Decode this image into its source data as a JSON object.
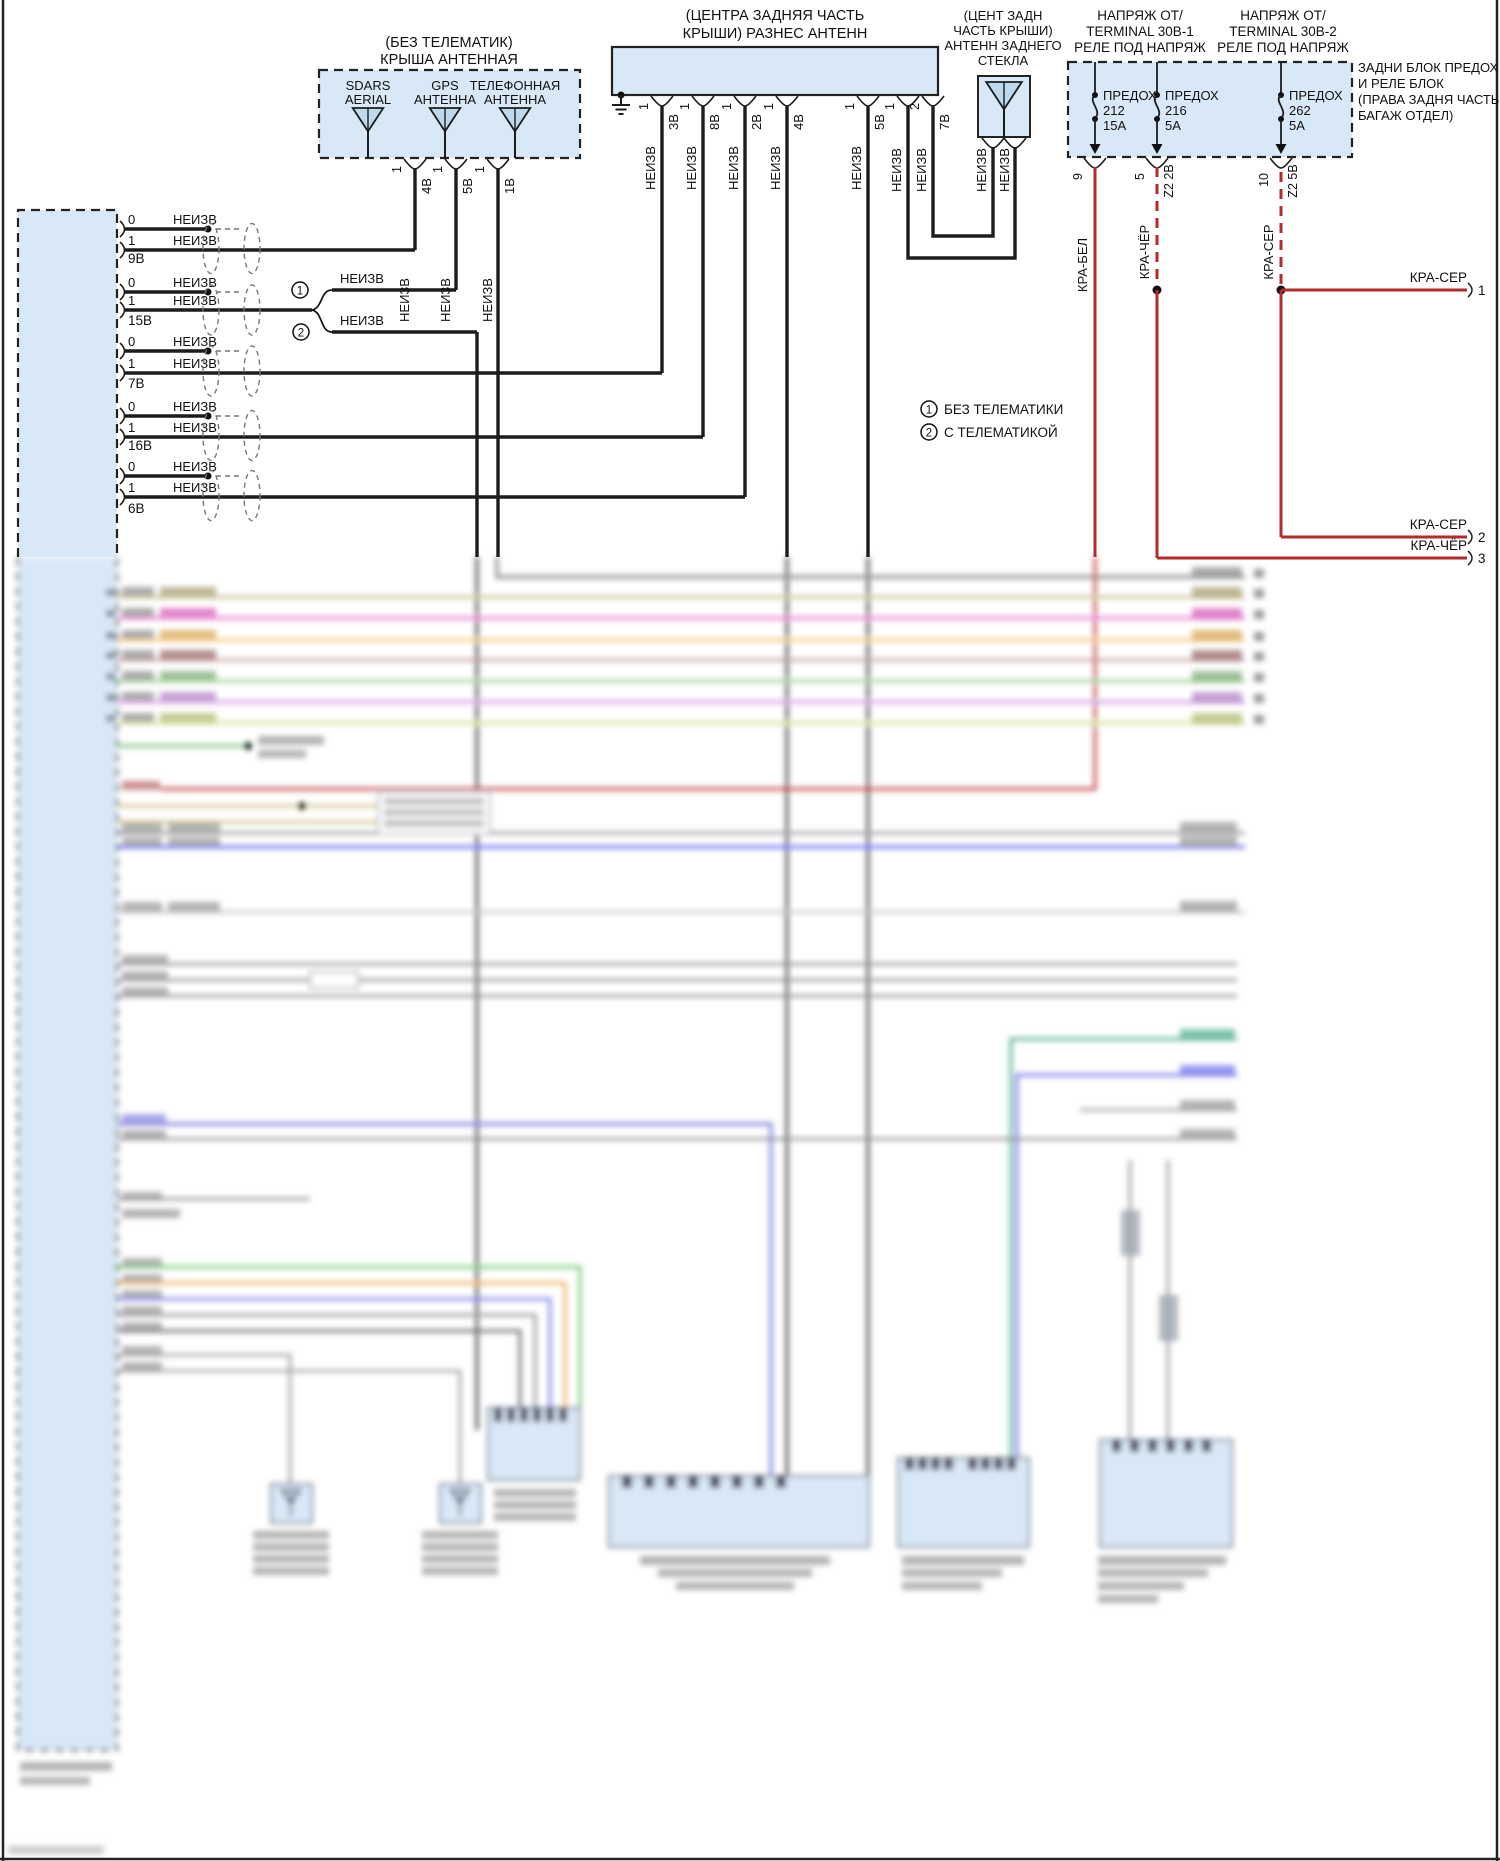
{
  "colors": {
    "box_fill": "#d9e8f7",
    "antenna_fill": "#bed8ee",
    "wire": "#1c1c1c",
    "red_wire": "#b32b2b",
    "border": "#222222"
  },
  "roof_antenna_module": {
    "title_line1": "(БЕЗ ТЕЛЕМАТИК)",
    "title_line2": "КРЫША АНТЕННАЯ",
    "antennas": [
      {
        "line1": "SDARS",
        "line2": "AERIAL"
      },
      {
        "line1": "GPS",
        "line2": "АНТЕННА"
      },
      {
        "line1": "ТЕЛЕФОННАЯ",
        "line2": "АНТЕННА"
      }
    ],
    "pins": [
      {
        "num": "1",
        "wire": "4В"
      },
      {
        "num": "1",
        "wire": "5В"
      },
      {
        "num": "1",
        "wire": "1В"
      }
    ]
  },
  "center_antenna_module": {
    "title_line1": "(ЦЕНТРА ЗАДНЯЯ ЧАСТЬ",
    "title_line2": "КРЫШИ) РАЗНЕС АНТЕНН",
    "pins": [
      {
        "num": "1",
        "wire": "3В"
      },
      {
        "num": "1",
        "wire": "8В"
      },
      {
        "num": "1",
        "wire": "2В"
      },
      {
        "num": "1",
        "wire": "4В"
      },
      {
        "num": "1",
        "wire": "5В"
      },
      {
        "num": "1",
        "wire": ""
      },
      {
        "num": "2",
        "wire": "7В"
      }
    ]
  },
  "rear_glass_antenna_module": {
    "title_lines": [
      "(ЦЕНТ ЗАДН",
      "ЧАСТЬ КРЫШИ)",
      "АНТЕНН ЗАДНЕГО",
      "СТЕКЛА"
    ]
  },
  "fuse_panel": {
    "source_left_lines": [
      "НАПРЯЖ ОТ/",
      "TERMINAL 30В-1",
      "РЕЛЕ ПОД НАПРЯЖ"
    ],
    "source_right_lines": [
      "НАПРЯЖ ОТ/",
      "TERMINAL 30В-2",
      "РЕЛЕ ПОД НАПРЯЖ"
    ],
    "location_note_lines": [
      "ЗАДНИ БЛОК ПРЕДОХ",
      "И РЕЛЕ БЛОК",
      "(ПРАВА ЗАДНЯ ЧАСТЬ",
      "БАГАЖ ОТДЕЛ)"
    ],
    "fuses": [
      {
        "label": "ПРЕДОХ",
        "number": "212",
        "rating": "15А"
      },
      {
        "label": "ПРЕДОХ",
        "number": "216",
        "rating": "5А"
      },
      {
        "label": "ПРЕДОХ",
        "number": "262",
        "rating": "5А"
      }
    ],
    "output_pins": [
      {
        "pin": "9",
        "circuit": ""
      },
      {
        "pin": "5",
        "circuit": "Z2 2В"
      },
      {
        "pin": "10",
        "circuit": "Z2 5В"
      }
    ]
  },
  "left_connector": {
    "pairs": [
      {
        "pin0": "0",
        "pin1": "1",
        "wire0": "НЕИЗВ",
        "wire1": "НЕИЗВ",
        "connector": "9В"
      },
      {
        "pin0": "0",
        "pin1": "1",
        "wire0": "НЕИЗВ",
        "wire1": "НЕИЗВ",
        "connector": "15В"
      },
      {
        "pin0": "0",
        "pin1": "1",
        "wire0": "НЕИЗВ",
        "wire1": "НЕИЗВ",
        "connector": "7В"
      },
      {
        "pin0": "0",
        "pin1": "1",
        "wire0": "НЕИЗВ",
        "wire1": "НЕИЗВ",
        "connector": "16В"
      },
      {
        "pin0": "0",
        "pin1": "1",
        "wire0": "НЕИЗВ",
        "wire1": "НЕИЗВ",
        "connector": "6В"
      }
    ]
  },
  "telematics_branch": {
    "option1_mark": "1",
    "option2_mark": "2",
    "option1_wire": "НЕИЗВ",
    "option2_wire": "НЕИЗВ"
  },
  "legend": [
    {
      "mark": "1",
      "text": "БЕЗ ТЕЛЕМАТИКИ"
    },
    {
      "mark": "2",
      "text": "С ТЕЛЕМАТИКОЙ"
    }
  ],
  "power_wires": {
    "kra_bel": "КРА-БЕЛ",
    "kra_cher": "КРА-ЧЁР",
    "kra_ser": "КРА-СЕР",
    "right_edge_pins": [
      {
        "label": "КРА-СЕР",
        "pin": "1"
      },
      {
        "label": "КРА-СЕР",
        "pin": "2"
      },
      {
        "label": "КРА-ЧЁР",
        "pin": "3"
      }
    ]
  }
}
